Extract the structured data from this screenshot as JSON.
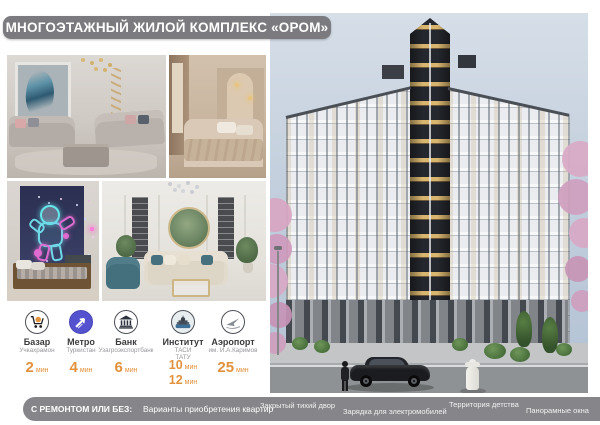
{
  "banner": {
    "title": "МНОГОЭТАЖНЫЙ ЖИЛОЙ КОМПЛЕКС «ОРОМ»"
  },
  "amenities": [
    {
      "icon": "market-cart-icon",
      "name": "Базар",
      "sub": "Учкахрамон",
      "time": "2",
      "unit": "мин"
    },
    {
      "icon": "metro-icon",
      "name": "Метро",
      "sub": "Туркистан",
      "time": "4",
      "unit": "мин"
    },
    {
      "icon": "bank-icon",
      "name": "Банк",
      "sub": "Узагроэкспортбанк",
      "time": "6",
      "unit": "мин"
    },
    {
      "icon": "institute-icon",
      "name": "Институт",
      "sub": "ТАСИ",
      "sub2": "ТАТУ",
      "time": "10",
      "unit": "мин",
      "time2": "12",
      "unit2": "мин"
    },
    {
      "icon": "airport-icon",
      "name": "Аэропорт",
      "sub": "им. И.А.Каримов",
      "time": "25",
      "unit": "мин"
    }
  ],
  "bottom_banner": {
    "highlight": "С РЕМОНТОМ ИЛИ БЕЗ:",
    "text": "Варианты приобретения квартир"
  },
  "features": [
    "Закрытый тихий двор",
    "Зарядка для электромобилей",
    "Территория детства",
    "Панорамные окна"
  ],
  "colors": {
    "banner_gray": "#7b7b7f",
    "accent_orange": "#e2913c",
    "metro_blue": "#5552cf",
    "neon_cyan": "#66e7ec",
    "neon_pink": "#e06bd0",
    "mirror_green": "#647e5c",
    "sky_blue": "#c3cfdd"
  }
}
